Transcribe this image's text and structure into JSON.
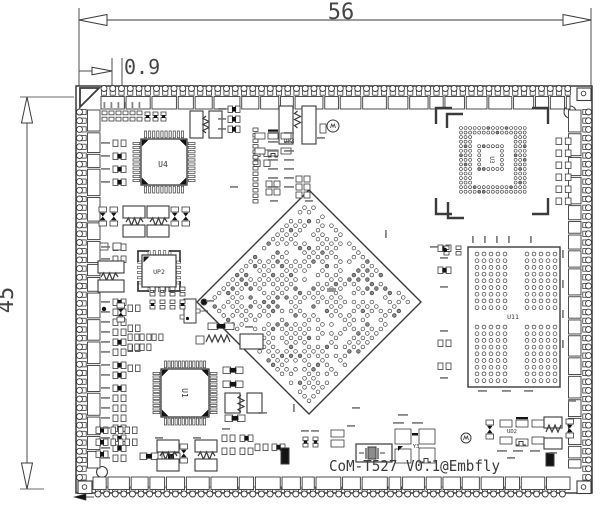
{
  "drawing": {
    "dim_width": "56",
    "dim_height": "45",
    "dim_pitch": "0.9",
    "silkscreen": "CoM-T527 V0.1@Embfly"
  },
  "components": {
    "u4": "U4",
    "up2": "UP2",
    "up3": "UP3",
    "u1": "U1",
    "u3": "U3",
    "u11": "U11",
    "ud2": "UD2",
    "y3": "Y3"
  },
  "colors": {
    "line": "#3a3a3a",
    "fill_dark": "#141414",
    "pad_gray": "#8c8c8c",
    "smudge": "#6f6f6f",
    "background": "#ffffff"
  }
}
